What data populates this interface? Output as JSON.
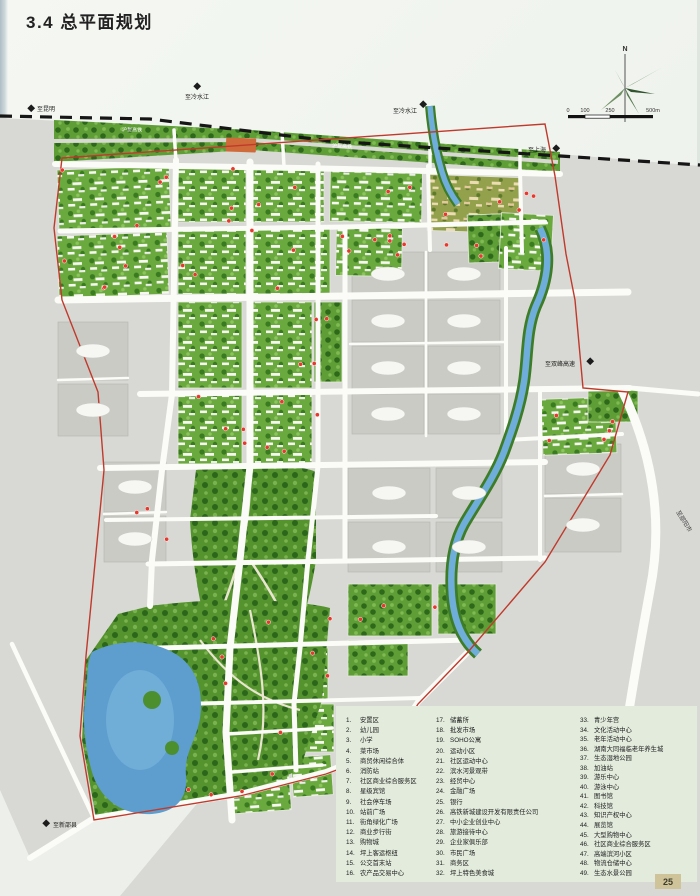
{
  "page": {
    "title": "3.4 总平面规划",
    "page_number": "25"
  },
  "compass": {
    "north_label": "N"
  },
  "scale_bar": {
    "t0": "0",
    "t1": "100",
    "t2": "250",
    "t3": "500m"
  },
  "map_labels": {
    "railway": "沪昆高铁",
    "to_kunming": "至昆明",
    "to_lengshuijiang": "至冷水江",
    "to_shanghai": "至上海",
    "to_shuangfeng_expressway": "至双峰高速",
    "to_shaoyang_city": "至邵阳市",
    "to_xinshao_county": "至新邵县"
  },
  "legend": {
    "columns": [
      {
        "items": [
          {
            "no": "1.",
            "label": "安置区"
          },
          {
            "no": "2.",
            "label": "幼儿园"
          },
          {
            "no": "3.",
            "label": "小学"
          },
          {
            "no": "4.",
            "label": "菜市场"
          },
          {
            "no": "5.",
            "label": "商贸休闲综合体"
          },
          {
            "no": "6.",
            "label": "消防站"
          },
          {
            "no": "7.",
            "label": "社区商业综合服务区"
          },
          {
            "no": "8.",
            "label": "星级宾馆"
          },
          {
            "no": "9.",
            "label": "社会停车场"
          },
          {
            "no": "10.",
            "label": "站前广场"
          },
          {
            "no": "11.",
            "label": "街角绿化广场"
          },
          {
            "no": "12.",
            "label": "商业步行街"
          },
          {
            "no": "13.",
            "label": "购物城"
          },
          {
            "no": "14.",
            "label": "坪上客运枢纽"
          },
          {
            "no": "15.",
            "label": "公交首末站"
          },
          {
            "no": "16.",
            "label": "农产品交易中心"
          }
        ]
      },
      {
        "items": [
          {
            "no": "17.",
            "label": "储蓄所"
          },
          {
            "no": "18.",
            "label": "批发市场"
          },
          {
            "no": "19.",
            "label": "SOHO公寓"
          },
          {
            "no": "20.",
            "label": "运动小区"
          },
          {
            "no": "21.",
            "label": "社区运动中心"
          },
          {
            "no": "22.",
            "label": "滨水河景观带"
          },
          {
            "no": "23.",
            "label": "经贸中心"
          },
          {
            "no": "24.",
            "label": "金融广场"
          },
          {
            "no": "25.",
            "label": "银行"
          },
          {
            "no": "26.",
            "label": "高铁新城建设开发有限责任公司"
          },
          {
            "no": "27.",
            "label": "中小企业创业中心"
          },
          {
            "no": "28.",
            "label": "旅游接待中心"
          },
          {
            "no": "29.",
            "label": "企业家俱乐部"
          },
          {
            "no": "30.",
            "label": "市民广场"
          },
          {
            "no": "31.",
            "label": "商务区"
          },
          {
            "no": "32.",
            "label": "坪上特色美食城"
          }
        ]
      },
      {
        "items": [
          {
            "no": "33.",
            "label": "青少年宫"
          },
          {
            "no": "34.",
            "label": "文化活动中心"
          },
          {
            "no": "35.",
            "label": "老年活动中心"
          },
          {
            "no": "36.",
            "label": "湖南大同福临老年养生城"
          },
          {
            "no": "37.",
            "label": "生态湿地公园"
          },
          {
            "no": "38.",
            "label": "加油站"
          },
          {
            "no": "39.",
            "label": "游乐中心"
          },
          {
            "no": "40.",
            "label": "游泳中心"
          },
          {
            "no": "41.",
            "label": "图书馆"
          },
          {
            "no": "42.",
            "label": "科技馆"
          },
          {
            "no": "43.",
            "label": "知识产权中心"
          },
          {
            "no": "44.",
            "label": "展览馆"
          },
          {
            "no": "45.",
            "label": "大型购物中心"
          },
          {
            "no": "46.",
            "label": "社区商业综合服务区"
          },
          {
            "no": "47.",
            "label": "高端滨河小区"
          },
          {
            "no": "48.",
            "label": "物流仓储中心"
          },
          {
            "no": "49.",
            "label": "生态水景公园"
          }
        ]
      }
    ]
  },
  "colors": {
    "boundary_red": "#c03a2c",
    "water_blue": "#6fadda",
    "green_dark": "#2e691b",
    "green_mid": "#6aa93d",
    "parcel_gray": "#cbcbc6",
    "legend_bg": "#e2ebdc"
  }
}
